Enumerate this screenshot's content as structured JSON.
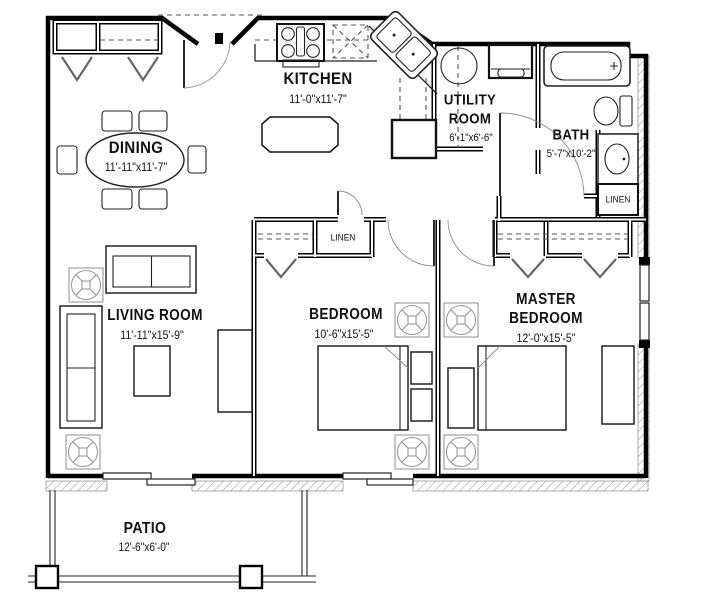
{
  "rooms": {
    "kitchen": {
      "name": "KITCHEN",
      "dims": "11'-0\"x11'-7\""
    },
    "dining": {
      "name": "DINING",
      "dims": "11'-11\"x11'-7\""
    },
    "utility": {
      "name1": "UTILITY",
      "name2": "ROOM",
      "dims": "6'-1\"x6'-6\""
    },
    "bath": {
      "name": "BATH",
      "dims": "5'-7\"x10'-2\""
    },
    "living": {
      "name": "LIVING ROOM",
      "dims": "11'-11\"x15'-9\""
    },
    "bedroom": {
      "name": "BEDROOM",
      "dims": "10'-6\"x15'-5\""
    },
    "master": {
      "name1": "MASTER",
      "name2": "BEDROOM",
      "dims": "12'-0\"x15'-5\""
    },
    "patio": {
      "name": "PATIO",
      "dims": "12'-6\"x6'-0\""
    }
  },
  "closets": {
    "linen_hall": "LINEN",
    "linen_bath": "LINEN"
  },
  "colors": {
    "line": "#000000",
    "furniture": "#222222",
    "soft": "#8a8a8a",
    "hatch": "#9a9a9a",
    "background": "#ffffff"
  }
}
